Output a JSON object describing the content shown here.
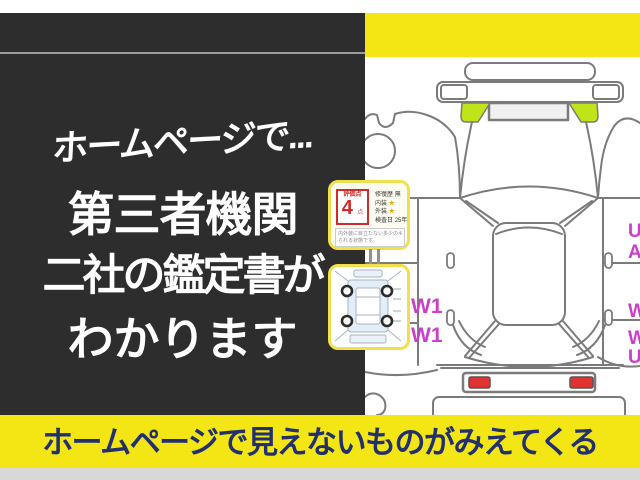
{
  "headline": {
    "line1": "ホームページで...",
    "line2": "第三者機関",
    "line3": "二社の鑑定書が",
    "line4": "わかります"
  },
  "banner": {
    "text": "ホームページで見えないものがみえてくる"
  },
  "rating_card": {
    "score_label": "評価点",
    "score_value": "4",
    "score_unit": "点",
    "rows": [
      {
        "label": "修復歴",
        "value": "無"
      },
      {
        "label": "内装",
        "value": "★"
      },
      {
        "label": "外装",
        "value": "★"
      },
      {
        "label": "検査日",
        "value": "25年"
      }
    ],
    "note_line1": "内外装に目立たない多少のキズ",
    "note_line2": "られる状態です。"
  },
  "diagram": {
    "left_marks": [
      "W1",
      "W1"
    ],
    "right_marks": [
      "U",
      "A",
      "W",
      "W",
      "U"
    ]
  },
  "colors": {
    "accent_yellow": "#f3e614",
    "highlight_green": "#bfe51a",
    "tail_light_red": "#e23333",
    "damage_mark_magenta": "#c93fc9",
    "banner_text_navy": "#22306e",
    "panel_dark": "#2e2d2d",
    "score_red": "#cf2b2b"
  }
}
